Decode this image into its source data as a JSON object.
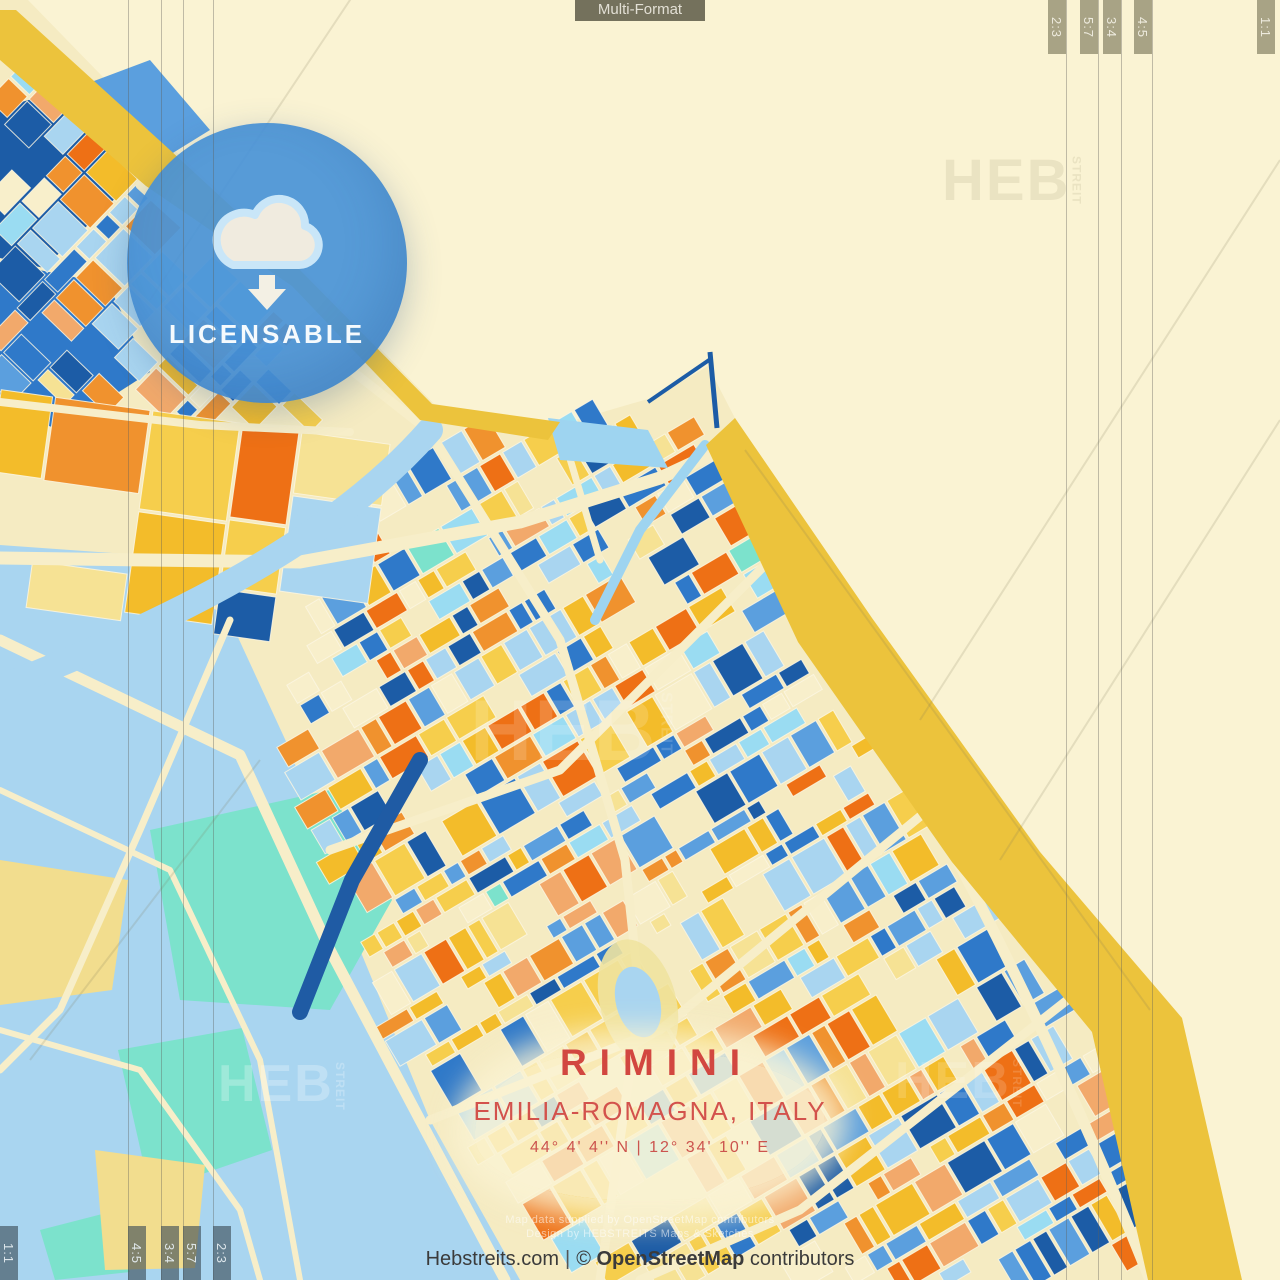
{
  "poster": {
    "format_label": "Multi-Format",
    "badge": {
      "label": "LICENSABLE",
      "icon": "cloud-download"
    },
    "title": {
      "city": "RIMINI",
      "region": "EMILIA-ROMAGNA, ITALY",
      "coordinates": "44° 4' 4'' N | 12° 34' 10'' E"
    },
    "credits": {
      "site": "Hebstreits.com",
      "separator": "|",
      "copyright": "©",
      "osm": "OpenStreetMap",
      "contributors": "contributors"
    },
    "watermark": {
      "big": "HEB",
      "small": "STREIT",
      "line1": "Map data supplied by OpenStreetMap contributors",
      "line2": "Design by HEBSTREITS Maps & Sketches"
    },
    "aspect_marks": {
      "top": [
        "2:3",
        "5:7",
        "3:4",
        "4:5",
        "1:1"
      ],
      "bottom": [
        "1:1",
        "4:5",
        "3:4",
        "5:7",
        "2:3"
      ]
    },
    "colors": {
      "sea": "#FAF3D3",
      "land": "#F5EBC2",
      "beach": "#ECC33C",
      "road": "#F7EEC9",
      "accent_red": "#D24740",
      "badge_blue": "#4A93D7",
      "palette": [
        "#1C5CA6",
        "#2F79C9",
        "#5B9FDE",
        "#A9D5F0",
        "#9ADCF2",
        "#7CE2CC",
        "#EE7015",
        "#F0922E",
        "#F2A96B",
        "#F3BC2A",
        "#F6CE4C",
        "#F6E294",
        "#F8EFCB"
      ]
    }
  }
}
